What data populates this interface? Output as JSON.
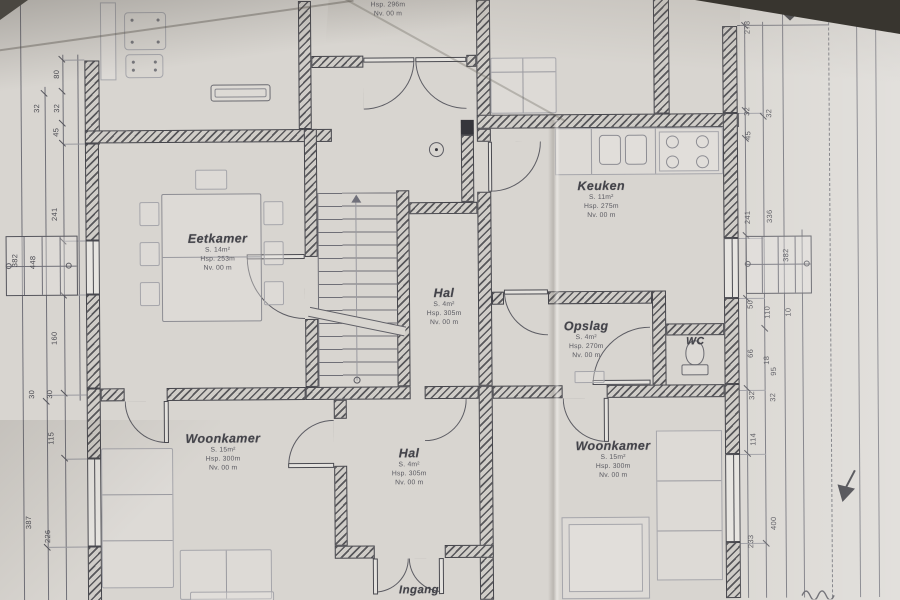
{
  "document": {
    "kind": "floor-plan photo",
    "language": "nl"
  },
  "colors": {
    "paper": "#d8d5d0",
    "ink": "#45454b",
    "light_ink": "#8d8d93"
  },
  "rooms": {
    "top": {
      "height": "Hsp. 296m",
      "level": "Nv. 00 m"
    },
    "eetkamer": {
      "name": "Eetkamer",
      "area": "S. 14m²",
      "height": "Hsp. 253m",
      "level": "Nv. 00 m"
    },
    "keuken": {
      "name": "Keuken",
      "area": "S. 11m²",
      "height": "Hsp. 275m",
      "level": "Nv. 00 m"
    },
    "halUpper": {
      "name": "Hal",
      "area": "S. 4m²",
      "height": "Hsp. 305m",
      "level": "Nv. 00 m"
    },
    "opslag": {
      "name": "Opslag",
      "area": "S. 4m²",
      "height": "Hsp. 270m",
      "level": "Nv. 00 m"
    },
    "wc": {
      "name": "WC"
    },
    "woonkamerLeft": {
      "name": "Woonkamer",
      "area": "S. 15m²",
      "height": "Hsp. 300m",
      "level": "Nv. 00 m"
    },
    "halLower": {
      "name": "Hal",
      "area": "S. 4m²",
      "height": "Hsp. 305m",
      "level": "Nv. 00 m"
    },
    "woonkamerRight": {
      "name": "Woonkamer",
      "area": "S. 15m²",
      "height": "Hsp. 300m",
      "level": "Nv. 00 m"
    },
    "entrance": {
      "label": "Ingang"
    }
  },
  "dims": {
    "l80": "80",
    "l32a": "32",
    "l32b": "32",
    "l45": "45",
    "l241": "241",
    "l160": "160",
    "l30a": "30",
    "l30b": "30",
    "l115": "115",
    "l387": "387",
    "l226": "226",
    "lb1": "382",
    "lb2": "448",
    "r278": "278",
    "r32a": "32",
    "r32b": "32",
    "r45": "45",
    "r241": "241",
    "r336": "336",
    "rbox": "382",
    "r50": "50",
    "r110": "110",
    "r10": "10",
    "r66": "66",
    "r18": "18",
    "r95": "95",
    "r32c": "32",
    "r32d": "32",
    "r114": "114",
    "r233": "233",
    "r400": "400"
  }
}
